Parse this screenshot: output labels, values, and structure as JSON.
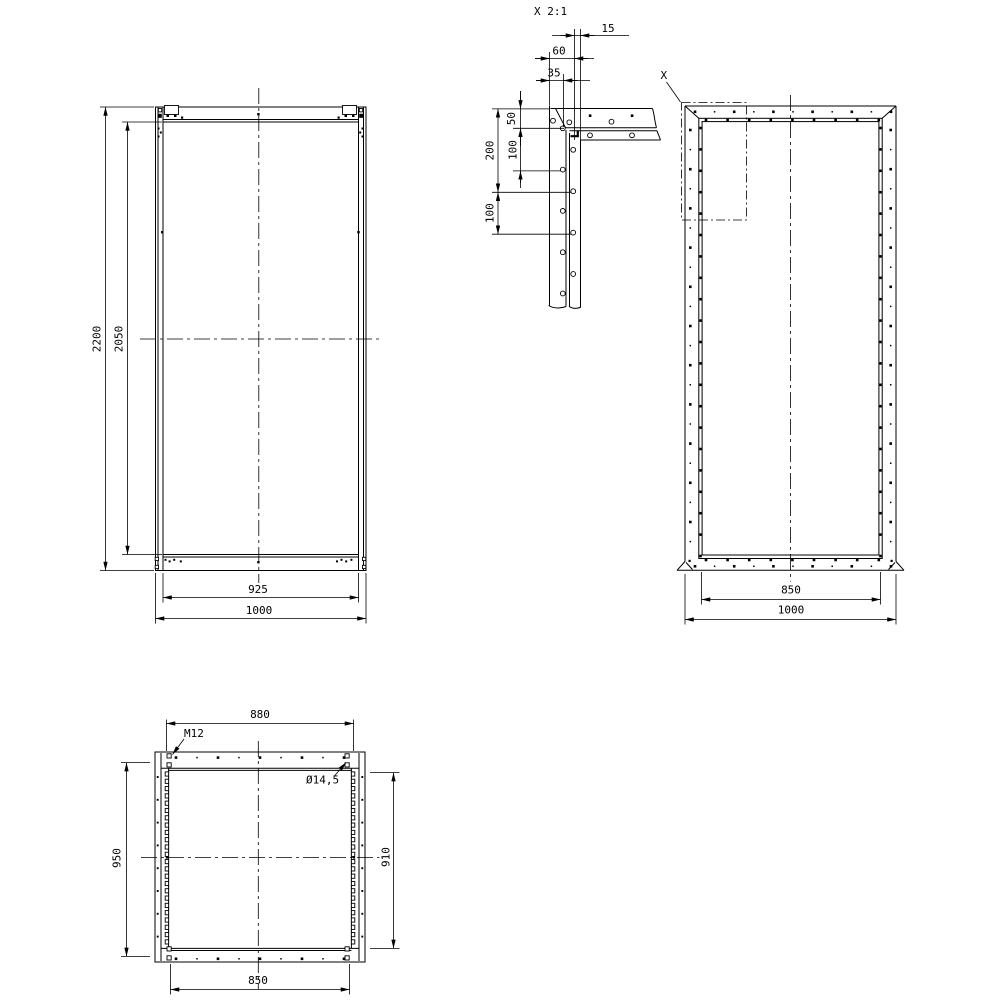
{
  "colors": {
    "background": "#ffffff",
    "line": "#000000"
  },
  "views": {
    "front": {
      "height_outer": "2200",
      "height_inner": "2050",
      "width_inner": "925",
      "width_outer": "1000"
    },
    "detail": {
      "title": "X 2:1",
      "dim_15": "15",
      "dim_60": "60",
      "dim_35": "35",
      "dim_50": "50",
      "dim_100_upper": "100",
      "dim_200": "200",
      "dim_100_lower": "100"
    },
    "side": {
      "marker": "X",
      "width_inner": "850",
      "width_outer": "1000"
    },
    "top": {
      "width_top": "880",
      "thread": "M12",
      "hole_dia": "Ø14,5",
      "depth_left": "950",
      "depth_right": "910",
      "width_bottom": "850"
    }
  }
}
